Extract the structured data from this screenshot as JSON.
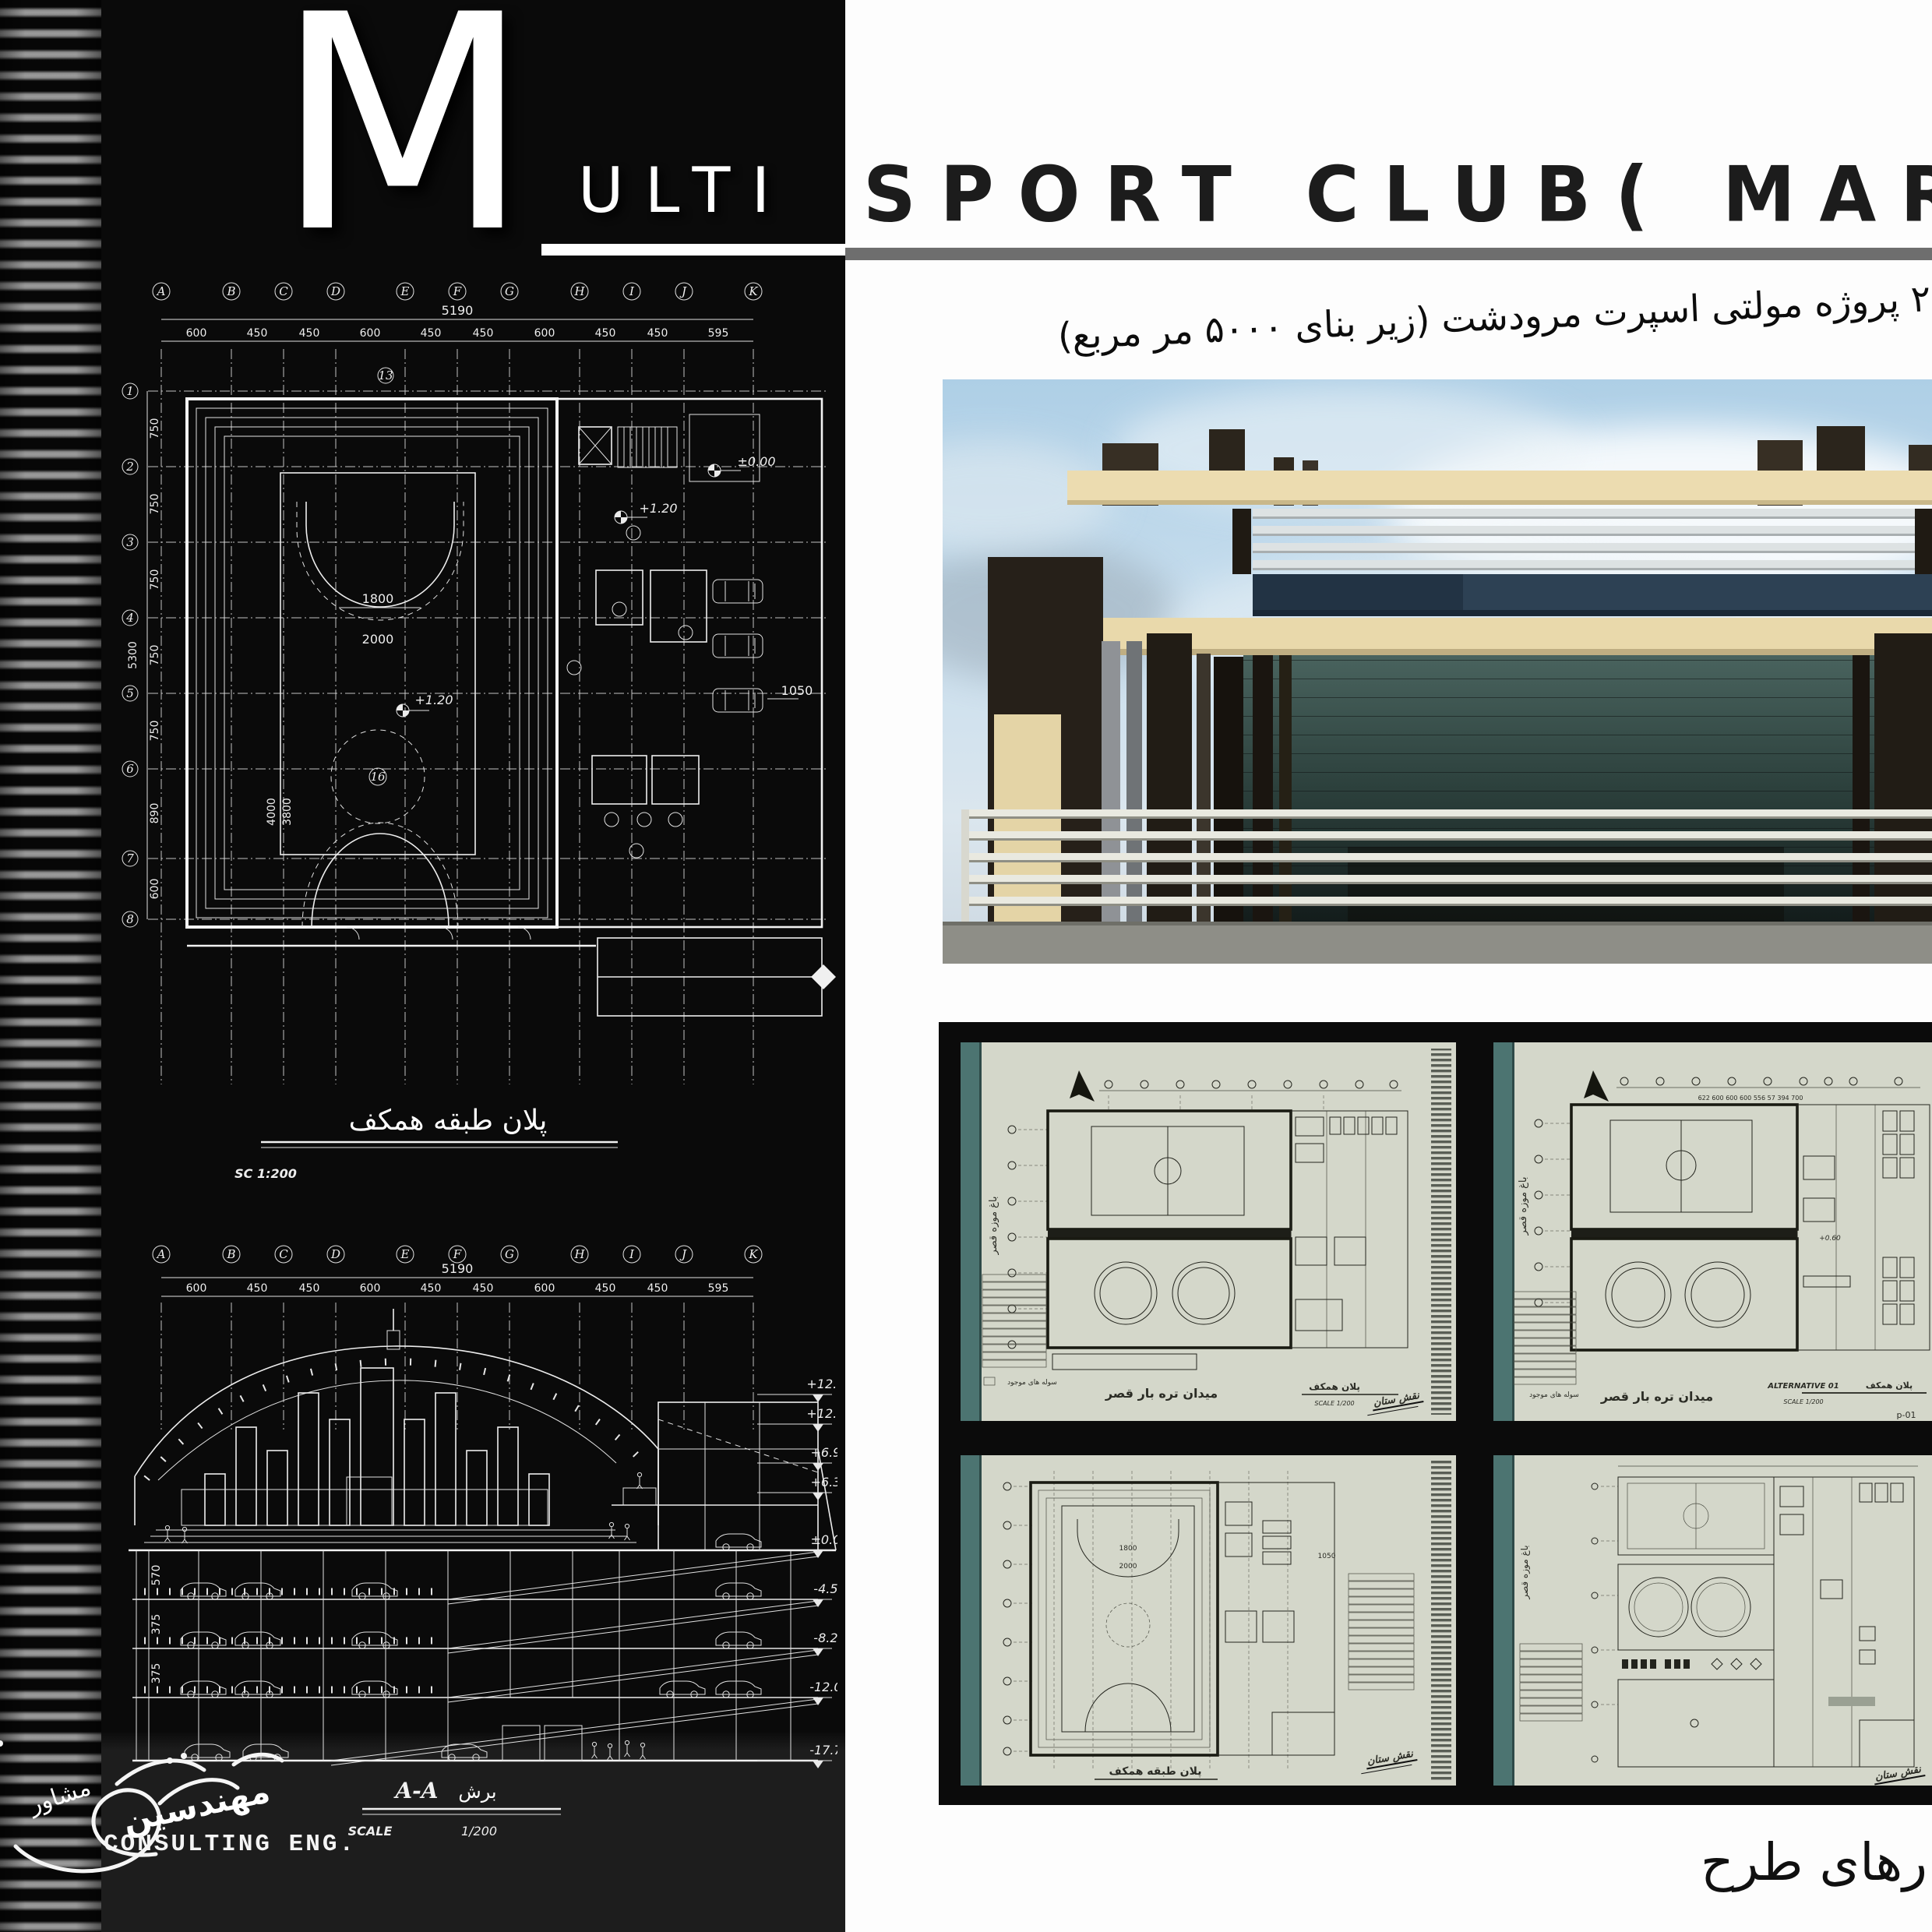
{
  "colors": {
    "panel": "#0a0a0a",
    "paper": "#d4d7ca",
    "teal_band": "#4c7471",
    "title_ink": "#1c1c1c",
    "underline_gray": "#6e6e6e",
    "cad_line": "#ededed",
    "render_cream": "#ecdcb0",
    "render_glass": "#2c403c",
    "render_sky": "#aecfe6"
  },
  "masthead": {
    "m": "M",
    "ulti": "ULTI",
    "title": "SPORT CLUB( MARVDAS",
    "subtitle_fa": "۲ پروژه مولتی اسپرت  مرودشت  (زیر بنای ۵۰۰۰ مر مربع)"
  },
  "plan": {
    "grid_letters": [
      "A",
      "B",
      "C",
      "D",
      "E",
      "F",
      "G",
      "H",
      "I",
      "J",
      "K"
    ],
    "grid_rows": [
      "1",
      "2",
      "3",
      "4",
      "5",
      "6",
      "7",
      "8"
    ],
    "overall_width": "5190",
    "col_dims": [
      "600",
      "450",
      "450",
      "600",
      "450",
      "450",
      "600",
      "450",
      "450",
      "595"
    ],
    "row_dims": [
      "750",
      "750",
      "750",
      "750",
      "750",
      "890",
      "600"
    ],
    "overall_height": "5300",
    "arc_inner": "1800",
    "arc_outer": "2000",
    "dim_w1": "4000",
    "dim_w2": "3800",
    "level_up": "+1.20",
    "level_zero": "±0.00",
    "dim_right": "1050",
    "room_no_13": "13",
    "room_no_16": "16",
    "title_fa": "پلان طبقه همکف",
    "scale": "SC  1:200"
  },
  "section": {
    "left_dims": [
      "570",
      "375",
      "375"
    ],
    "levels": [
      "+12.60",
      "+12.00",
      "+6.90",
      "+6.30",
      "±0.00",
      "-4.50",
      "-8.25",
      "-12.00",
      "-17.70"
    ],
    "title_latin": "A-A",
    "title_fa": "برش",
    "scale_label": "SCALE",
    "scale_value": "1/200"
  },
  "logo": {
    "signature_fa": "مهندسین",
    "signature_fa2": "مشاور",
    "text": "CONSULTING ENG."
  },
  "sheets": {
    "top_left": {
      "site_fa": "میدان تره بار قصر",
      "plan_fa": "پلان همکف",
      "scale": "SCALE   1/200",
      "side_fa": "باغ موزه قصر",
      "legend_fa": "سوله های موجود",
      "stamp_fa": "نقش ستان"
    },
    "top_right": {
      "alt": "ALTERNATIVE 01",
      "plan_fa": "پلان همکف",
      "scale": "SCALE   1/200",
      "sheet_no": "p-01",
      "site_fa": "میدان تره بار قصر",
      "side_fa": "باغ موزه قصر",
      "legend_fa": "سوله های موجود",
      "dims": "622   600   600   600   556   57  394   700",
      "level": "+0.60"
    },
    "bottom_left": {
      "title_fa": "پلان طبقه همکف",
      "arc_inner": "1800",
      "arc_outer": "2000",
      "dim": "1050",
      "stamp_fa": "نقش ستان"
    },
    "bottom_right": {
      "side_fa": "باغ موزه قصر",
      "stamp_fa": "نقش ستان"
    }
  },
  "caption_fa": "رهای طرح"
}
